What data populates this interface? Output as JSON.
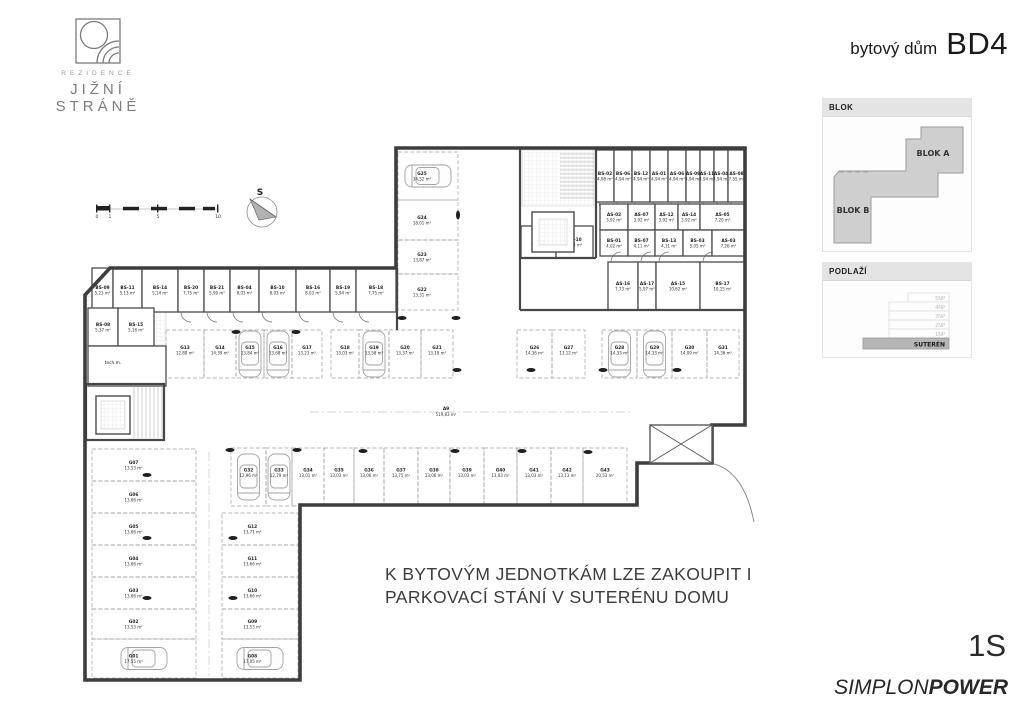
{
  "header": {
    "logo": {
      "brand_top": "REZIDENCE",
      "brand_bottom": "JIŽNÍ STRÁNĚ"
    },
    "title_prefix": "bytový dům",
    "title_main": "BD4"
  },
  "sidebar": {
    "blok_panel": {
      "title": "BLOK",
      "blok_a": "BLOK A",
      "blok_b": "BLOK B"
    },
    "podlazi_panel": {
      "title": "PODLAŽÍ",
      "floors": [
        "5NP",
        "4NP",
        "3NP",
        "2NP",
        "1NP"
      ],
      "highlighted": "SUTERÉN"
    }
  },
  "note": {
    "line1": "K BYTOVÝM JEDNOTKÁM LZE ZAKOUPIT I",
    "line2": "PARKOVACÍ STÁNÍ V SUTERÉNU DOMU"
  },
  "footer": {
    "floor_code": "1S",
    "brand_normal": "SIMPLON",
    "brand_bold": "POWER"
  },
  "colors": {
    "wall": "#3d3d3d",
    "blok_fill": "#cfcfcf",
    "suteren_fill": "#b5b5b5"
  },
  "plan": {
    "north_label": "S",
    "scale_labels": [
      "0",
      "1",
      "5",
      "10"
    ],
    "tech_room_label": "tech.m.",
    "aisle_label": {
      "id": "A9",
      "area": "519,83 m²"
    },
    "storage_rows": [
      {
        "name": "west-top",
        "y": 268,
        "h": 44,
        "door": "down",
        "rooms": [
          {
            "id": "BS-09",
            "area": "5,23 m²",
            "x": 92,
            "w": 21
          },
          {
            "id": "BS-11",
            "area": "5,13 m²",
            "x": 113,
            "w": 29
          },
          {
            "id": "BS-14",
            "area": "5,14 m²",
            "x": 142,
            "w": 36
          },
          {
            "id": "BS-20",
            "area": "7,75 m²",
            "x": 178,
            "w": 26
          },
          {
            "id": "BS-21",
            "area": "5,99 m²",
            "x": 204,
            "w": 26
          },
          {
            "id": "BS-04",
            "area": "8,03 m²",
            "x": 230,
            "w": 29
          },
          {
            "id": "BS-10",
            "area": "8,03 m²",
            "x": 259,
            "w": 37
          },
          {
            "id": "BS-16",
            "area": "8,03 m²",
            "x": 296,
            "w": 34
          },
          {
            "id": "BS-19",
            "area": "5,94 m²",
            "x": 330,
            "w": 26
          },
          {
            "id": "BS-18",
            "area": "7,75 m²",
            "x": 356,
            "w": 40
          }
        ]
      },
      {
        "name": "west-small",
        "y": 308,
        "h": 38,
        "rooms": [
          {
            "id": "BS-08",
            "area": "5,37 m²",
            "x": 88,
            "w": 30
          },
          {
            "id": "BS-15",
            "area": "5,16 m²",
            "x": 118,
            "w": 36
          }
        ]
      },
      {
        "name": "blockA-top",
        "y": 150,
        "h": 52,
        "door": "down",
        "rooms": [
          {
            "id": "BS-02",
            "area": "4,98 m²",
            "x": 596,
            "w": 18
          },
          {
            "id": "BS-06",
            "area": "4,94 m²",
            "x": 614,
            "w": 18
          },
          {
            "id": "BS-12",
            "area": "4,94 m²",
            "x": 632,
            "w": 18
          },
          {
            "id": "AS-01",
            "area": "4,94 m²",
            "x": 650,
            "w": 18
          },
          {
            "id": "AS-06",
            "area": "4,94 m²",
            "x": 668,
            "w": 18
          },
          {
            "id": "AS-09",
            "area": "4,94 m²",
            "x": 686,
            "w": 14
          },
          {
            "id": "AS-11",
            "area": "4,94 m²",
            "x": 700,
            "w": 14
          },
          {
            "id": "AS-04",
            "area": "4,94 m²",
            "x": 714,
            "w": 14
          },
          {
            "id": "AS-08",
            "area": "7,55 m²",
            "x": 728,
            "w": 17
          }
        ]
      },
      {
        "name": "blockA-mid1",
        "y": 204,
        "h": 26,
        "rooms": [
          {
            "id": "AS-02",
            "area": "3,92 m²",
            "x": 600,
            "w": 28
          },
          {
            "id": "AS-07",
            "area": "3,92 m²",
            "x": 628,
            "w": 27
          },
          {
            "id": "AS-12",
            "area": "3,92 m²",
            "x": 655,
            "w": 23
          },
          {
            "id": "AS-14",
            "area": "3,92 m²",
            "x": 678,
            "w": 22
          },
          {
            "id": "AS-05",
            "area": "7,20 m²",
            "x": 700,
            "w": 45
          }
        ]
      },
      {
        "name": "blockA-mid2",
        "y": 230,
        "h": 26,
        "rooms": [
          {
            "id": "BS-01",
            "area": "4,02 m²",
            "x": 600,
            "w": 28
          },
          {
            "id": "BS-07",
            "area": "4,11 m²",
            "x": 628,
            "w": 27
          },
          {
            "id": "BS-13",
            "area": "4,11 m²",
            "x": 655,
            "w": 28
          },
          {
            "id": "BS-03",
            "area": "5,05 m²",
            "x": 683,
            "w": 29
          },
          {
            "id": "AS-03",
            "area": "7,26 m²",
            "x": 712,
            "w": 33
          }
        ]
      },
      {
        "name": "blockA-left",
        "y": 226,
        "h": 32,
        "rooms": [
          {
            "id": "AS-13",
            "area": "7,08 m²",
            "x": 521,
            "w": 35
          },
          {
            "id": "AS-10",
            "area": "7,04 m²",
            "x": 556,
            "w": 37
          }
        ]
      },
      {
        "name": "blockA-bottom",
        "y": 262,
        "h": 48,
        "door": "up",
        "rooms": [
          {
            "id": "AS-16",
            "area": "7,73 m²",
            "x": 608,
            "w": 30
          },
          {
            "id": "AS-17",
            "area": "5,97 m²",
            "x": 638,
            "w": 18
          },
          {
            "id": "AS-15",
            "area": "10,62 m²",
            "x": 656,
            "w": 44
          },
          {
            "id": "BS-17",
            "area": "10,15 m²",
            "x": 700,
            "w": 45
          }
        ]
      }
    ],
    "parking_groups": [
      {
        "name": "top-row",
        "orient": "v",
        "y": 330,
        "h": 48,
        "stalls": [
          {
            "id": "G13",
            "area": "12,88 m²",
            "x": 166,
            "w": 38
          },
          {
            "id": "G14",
            "area": "14,39 m²",
            "x": 204,
            "w": 32
          },
          {
            "id": "G15",
            "area": "13,84 m²",
            "x": 236,
            "w": 28,
            "car": true
          },
          {
            "id": "G16",
            "area": "13,68 m²",
            "x": 264,
            "w": 28,
            "car": true
          },
          {
            "id": "G17",
            "area": "13,23 m²",
            "x": 292,
            "w": 30
          },
          {
            "id": "G18",
            "area": "13,03 m²",
            "x": 331,
            "w": 28
          },
          {
            "id": "G19",
            "area": "13,58 m²",
            "x": 359,
            "w": 30,
            "car": true
          },
          {
            "id": "G20",
            "area": "13,37 m²",
            "x": 389,
            "w": 32
          },
          {
            "id": "G21",
            "area": "13,18 m²",
            "x": 421,
            "w": 32
          },
          {
            "id": "G26",
            "area": "14,36 m²",
            "x": 517,
            "w": 35
          },
          {
            "id": "G27",
            "area": "13,12 m²",
            "x": 552,
            "w": 33
          },
          {
            "id": "G28",
            "area": "14,33 m²",
            "x": 602,
            "w": 35,
            "car": true
          },
          {
            "id": "G29",
            "area": "14,33 m²",
            "x": 637,
            "w": 35,
            "car": true
          },
          {
            "id": "G30",
            "area": "14,09 m²",
            "x": 672,
            "w": 35
          },
          {
            "id": "G31",
            "area": "14,36 m²",
            "x": 707,
            "w": 32
          }
        ]
      },
      {
        "name": "bottom-row",
        "orient": "v",
        "y": 448,
        "h": 58,
        "stalls": [
          {
            "id": "G32",
            "area": "12,96 m²",
            "x": 231,
            "w": 35,
            "car": true
          },
          {
            "id": "G33",
            "area": "12,79 m²",
            "x": 266,
            "w": 26,
            "car": true
          },
          {
            "id": "G34",
            "area": "13,01 m²",
            "x": 292,
            "w": 32
          },
          {
            "id": "G35",
            "area": "13,03 m²",
            "x": 324,
            "w": 30
          },
          {
            "id": "G36",
            "area": "13,06 m²",
            "x": 354,
            "w": 30
          },
          {
            "id": "G37",
            "area": "13,75 m²",
            "x": 384,
            "w": 34
          },
          {
            "id": "G38",
            "area": "13,06 m²",
            "x": 418,
            "w": 32
          },
          {
            "id": "G39",
            "area": "13,03 m²",
            "x": 450,
            "w": 34
          },
          {
            "id": "G40",
            "area": "13,03 m²",
            "x": 484,
            "w": 33
          },
          {
            "id": "G41",
            "area": "13,03 m²",
            "x": 517,
            "w": 34
          },
          {
            "id": "G42",
            "area": "13,13 m²",
            "x": 551,
            "w": 32
          },
          {
            "id": "G43",
            "area": "20,53 m²",
            "x": 583,
            "w": 44
          }
        ]
      },
      {
        "name": "west-left-col",
        "orient": "h",
        "x": 92,
        "w": 104,
        "stalls": [
          {
            "id": "G07",
            "area": "13,53 m²",
            "y": 449,
            "h": 32
          },
          {
            "id": "G06",
            "area": "13,66 m²",
            "y": 481,
            "h": 32
          },
          {
            "id": "G05",
            "area": "13,66 m²",
            "y": 513,
            "h": 32
          },
          {
            "id": "G04",
            "area": "13,66 m²",
            "y": 545,
            "h": 32
          },
          {
            "id": "G03",
            "area": "13,66 m²",
            "y": 577,
            "h": 32
          },
          {
            "id": "G02",
            "area": "13,53 m²",
            "y": 609,
            "h": 30
          },
          {
            "id": "G01",
            "area": "17,55 m²",
            "y": 639,
            "h": 39,
            "car": true
          }
        ]
      },
      {
        "name": "west-right-col",
        "orient": "h",
        "x": 222,
        "w": 76,
        "stalls": [
          {
            "id": "G12",
            "area": "13,71 m²",
            "y": 513,
            "h": 32
          },
          {
            "id": "G11",
            "area": "13,66 m²",
            "y": 545,
            "h": 32
          },
          {
            "id": "G10",
            "area": "13,66 m²",
            "y": 577,
            "h": 32
          },
          {
            "id": "G09",
            "area": "13,53 m²",
            "y": 609,
            "h": 30
          },
          {
            "id": "G08",
            "area": "17,05 m²",
            "y": 639,
            "h": 39,
            "car": true
          }
        ]
      },
      {
        "name": "center-strip",
        "orient": "h",
        "x": 398,
        "w": 60,
        "stalls": [
          {
            "id": "G25",
            "area": "34,52 m²",
            "y": 152,
            "h": 48,
            "car": true
          },
          {
            "id": "G24",
            "area": "18,01 m²",
            "y": 200,
            "h": 40
          },
          {
            "id": "G23",
            "area": "13,87 m²",
            "y": 240,
            "h": 34
          },
          {
            "id": "G22",
            "area": "13,31 m²",
            "y": 274,
            "h": 36
          }
        ]
      }
    ],
    "pillars": [
      [
        402,
        318
      ],
      [
        456,
        318
      ],
      [
        458,
        215,
        "v"
      ],
      [
        236,
        332
      ],
      [
        296,
        332
      ],
      [
        457,
        370
      ],
      [
        531,
        370
      ],
      [
        603,
        370
      ],
      [
        677,
        370
      ],
      [
        230,
        450
      ],
      [
        297,
        450
      ],
      [
        363,
        451
      ],
      [
        455,
        451
      ],
      [
        522,
        451
      ],
      [
        588,
        452
      ],
      [
        147,
        475
      ],
      [
        147,
        538
      ],
      [
        147,
        598
      ],
      [
        233,
        538
      ],
      [
        233,
        598
      ]
    ]
  }
}
